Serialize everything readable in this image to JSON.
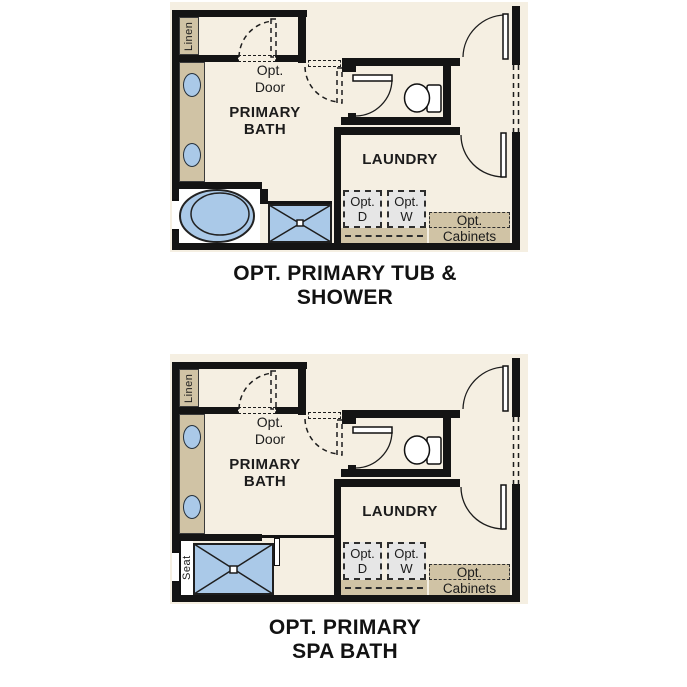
{
  "colors": {
    "page": "#ffffff",
    "floor": "#f5efe2",
    "wall": "#141414",
    "tan": "#d0c3a5",
    "blue": "#aac9e8",
    "gray": "#e6e6e6",
    "ink": "#1c1c1c"
  },
  "labels": {
    "linen": "Linen",
    "opt_door_line1": "Opt.",
    "opt_door_line2": "Door",
    "primary_bath_line1": "PRIMARY",
    "primary_bath_line2": "BATH",
    "laundry": "LAUNDRY",
    "opt_dryer_line1": "Opt.",
    "opt_dryer_line2": "D",
    "opt_washer_line1": "Opt.",
    "opt_washer_line2": "W",
    "opt_cabinets_line1": "Opt.",
    "opt_cabinets_line2": "Cabinets",
    "seat": "Seat"
  },
  "titles": {
    "plan_top_line1": "OPT. PRIMARY TUB &",
    "plan_top_line2": "SHOWER",
    "plan_bottom_line1": "OPT. PRIMARY",
    "plan_bottom_line2": "SPA BATH"
  }
}
